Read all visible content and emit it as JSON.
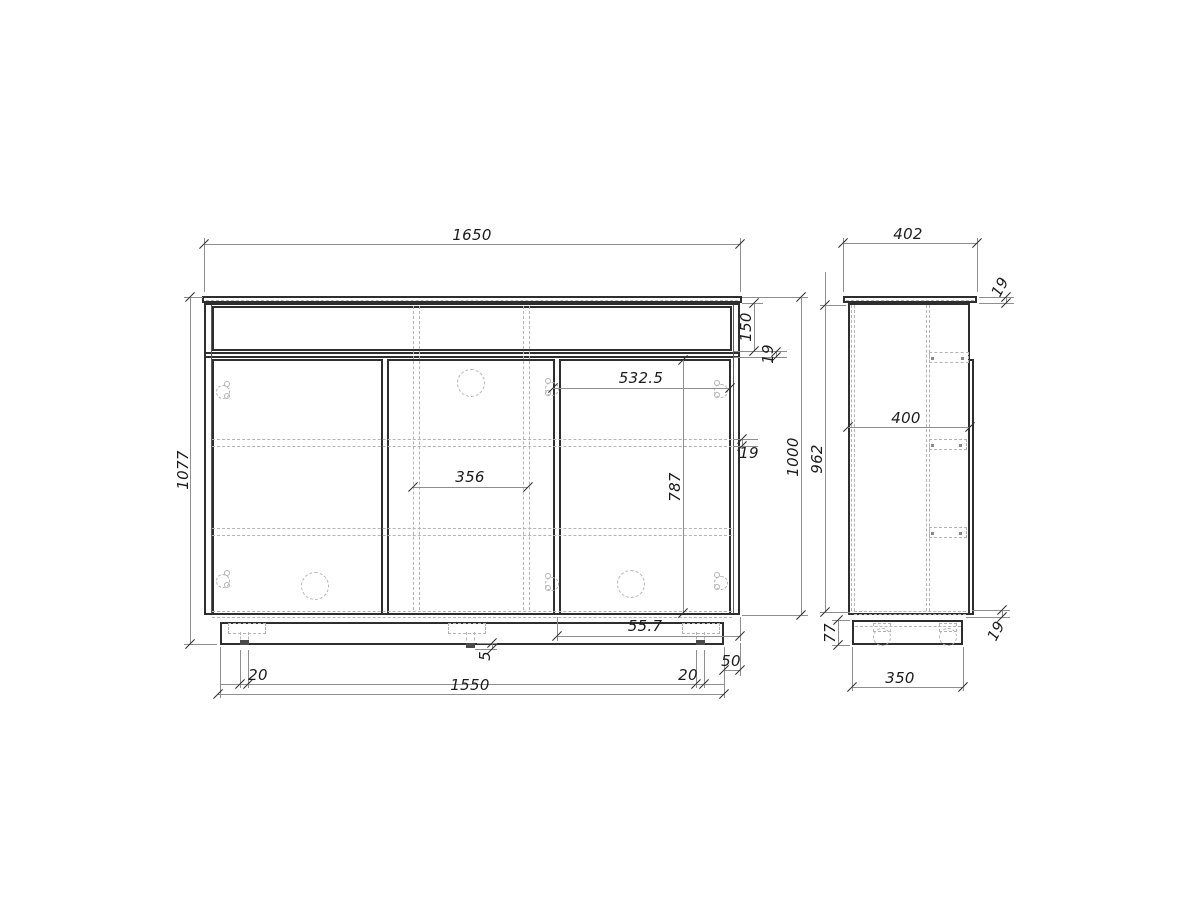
{
  "drawing": {
    "type": "furniture technical drawing",
    "palette": {
      "background": "#ffffff",
      "outline": "#2e2e2e",
      "dimension_line": "#8f8f8f",
      "hidden_line": "#b4b4b4",
      "text": "#1c1c1c"
    },
    "front": {
      "overall_width": "1650",
      "overall_height": "1077",
      "drawer_height": "150",
      "divider_thickness": "19",
      "carcass_height": "1000",
      "right_door_width": "532.5",
      "shelf_thickness": "19",
      "partition_spacing": "356",
      "door_height": "787",
      "plinth_right_offset": "55.7",
      "plinth_side_inset": "50",
      "center_leg_protrusion": "5",
      "left_leg_width": "20",
      "plinth_width": "1550",
      "right_leg_width": "20"
    },
    "side": {
      "overall_depth": "402",
      "top_panel_thickness": "19",
      "side_panel_height": "962",
      "inner_depth": "400",
      "plinth_height": "77",
      "bottom_panel_thickness": "19",
      "plinth_depth": "350"
    }
  }
}
